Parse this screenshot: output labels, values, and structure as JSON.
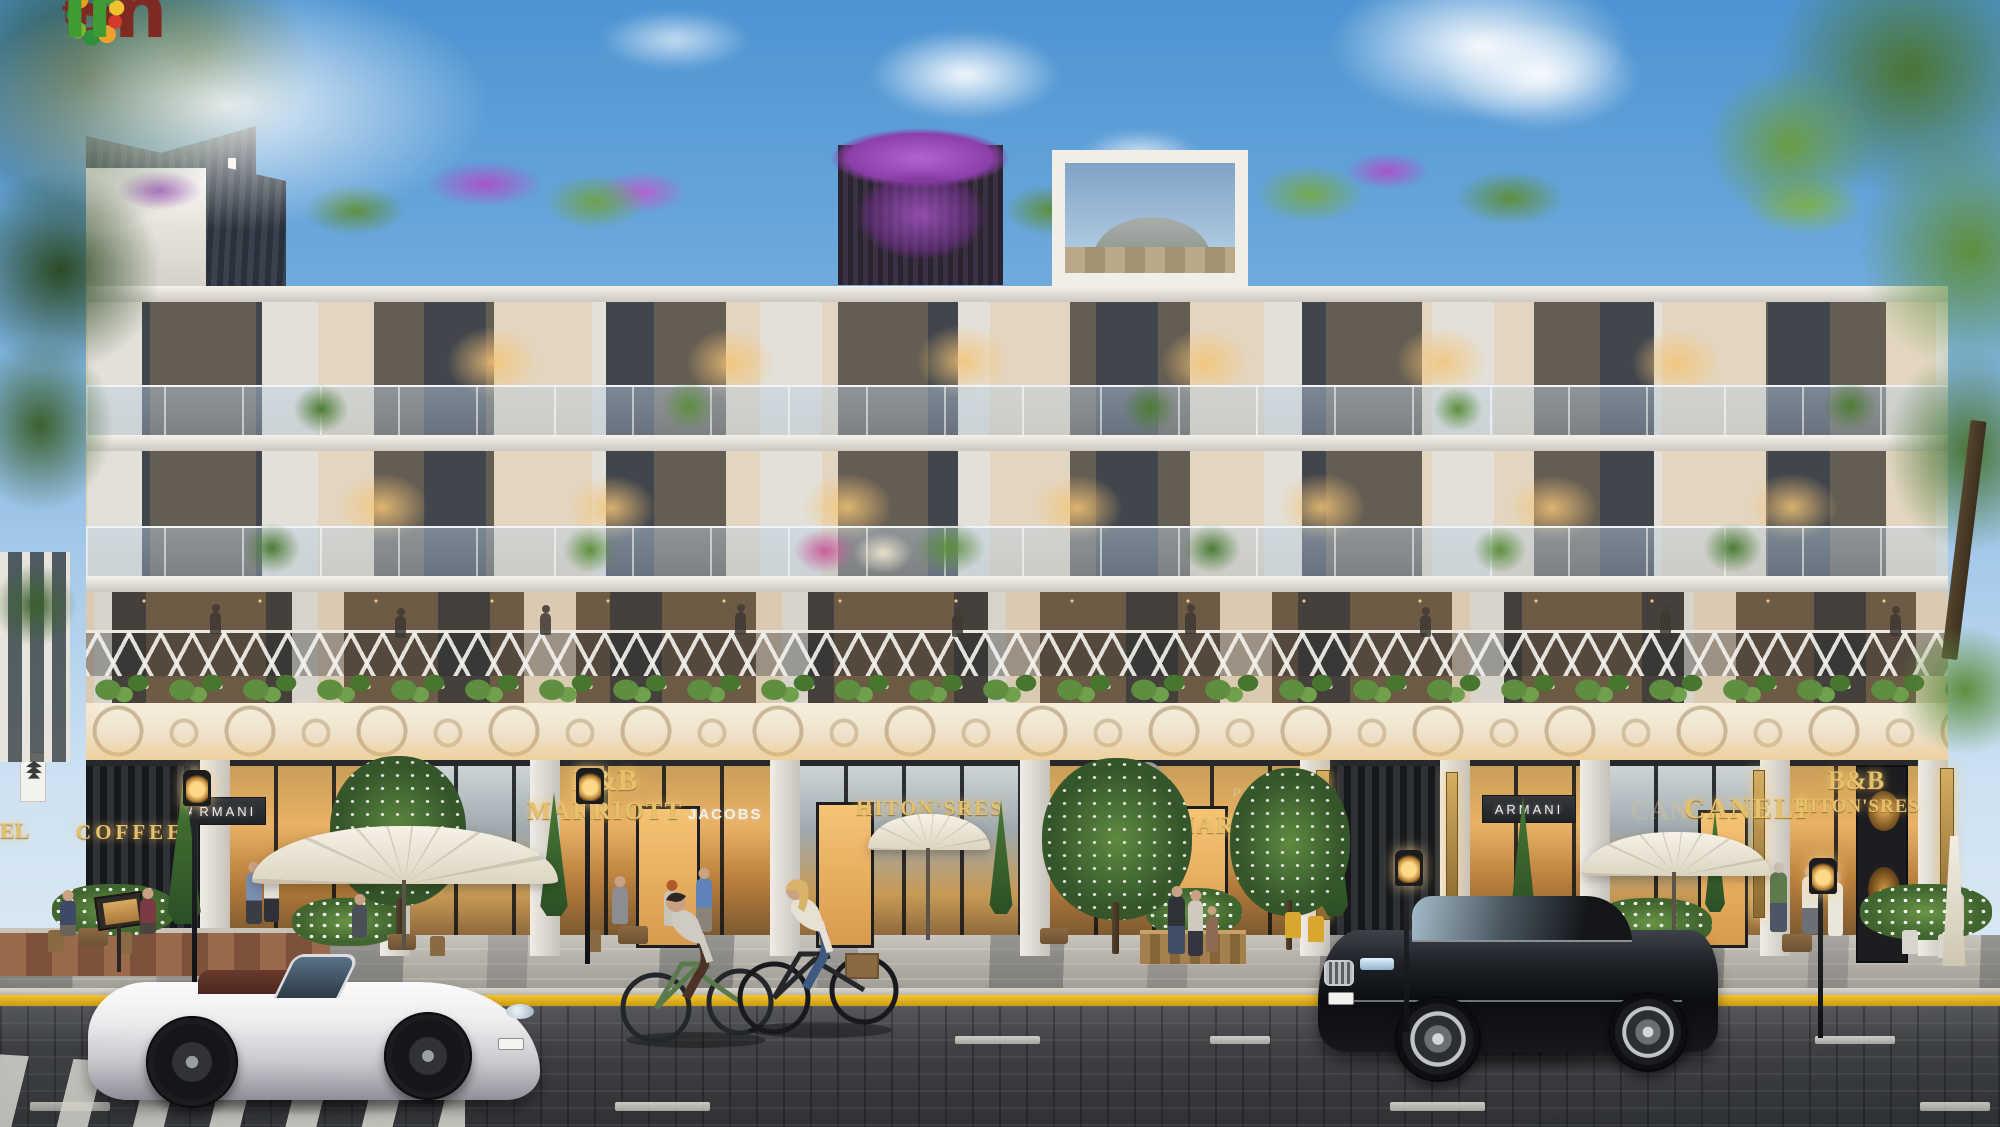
{
  "page": {
    "title": "The Sholi residential street facade render"
  },
  "logo": {
    "word_prefix": "the",
    "word_part1": "Sh",
    "word_part2": "li",
    "text_color_maroon": "#7e2a22",
    "text_color_green": "#3f9c35",
    "o_ring_colors": [
      "#e8a020",
      "#1f8a4c",
      "#7ab52f",
      "#2e8f3c",
      "#f0a02c",
      "#d43a2a",
      "#f2c12e",
      "#3f9c35",
      "#d4322e",
      "#f2c12e"
    ],
    "satellite_dot_colors": [
      "#e2551f",
      "#f2c12e",
      "#3f9c35",
      "#2e8f3c"
    ]
  },
  "signs": {
    "gold_color": "#e6c06a",
    "white_color": "#f2efe8",
    "left_partial": {
      "text": "EL"
    },
    "coffee": {
      "text": "COFFEE"
    },
    "armani_left": {
      "text": "ARMANI"
    },
    "bb_marriott": {
      "line1": "B&B",
      "line2": "MARRIOTT"
    },
    "jacobs": {
      "text": "JACOBS"
    },
    "hitons_left": {
      "text": "HITON'SRES"
    },
    "prada": {
      "text": "PRADA"
    },
    "marriott_center": {
      "text": "MARRIOTT"
    },
    "armani_right": {
      "text": "ARMANI"
    },
    "caneli_reflection": {
      "text": "CAN"
    },
    "caneli": {
      "text": "CANELI"
    },
    "bb_right": {
      "line1": "B&B",
      "line2": "HITON'SRES"
    }
  },
  "palette": {
    "sky_top": "#4d94d2",
    "sky_horizon": "#cfe2f2",
    "facade_cream": "#e3e0d9",
    "facade_dark": "#41454c",
    "roof_slate": "#323a46",
    "bougainvillea_purple": "#a855c8",
    "foliage_green": "#4e7c36",
    "frieze_cream": "#efe6d4",
    "storefront_glow": "#e9b267",
    "signage_gold": "#e6c06a",
    "sidewalk_gray": "#b3afa7",
    "curb_yellow": "#e6b41e",
    "road_charcoal": "#3e4043",
    "sports_car_white": "#ececee",
    "sedan_black": "#121418"
  }
}
